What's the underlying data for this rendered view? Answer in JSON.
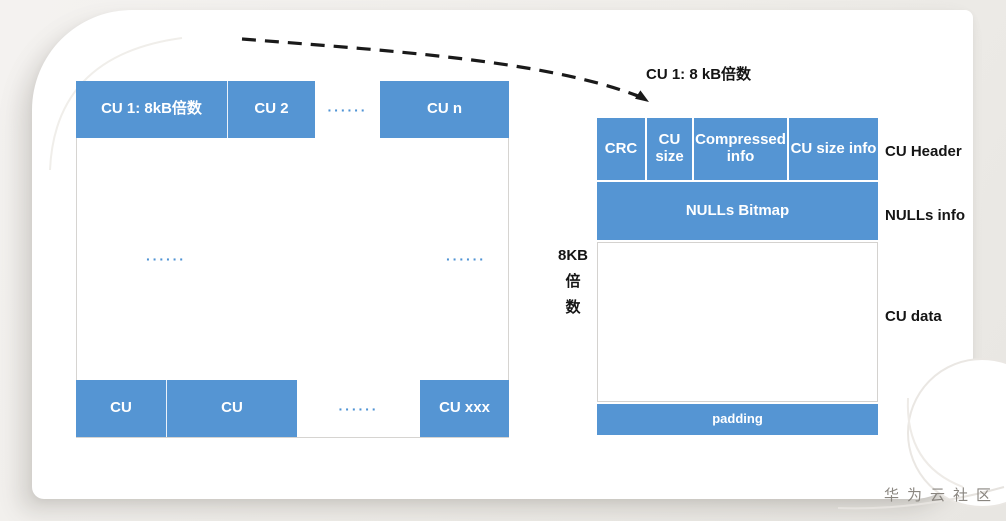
{
  "colors": {
    "accent_blue": "#5595d3",
    "page_bg": "#f1efec",
    "card_bg": "#ffffff",
    "border_gray": "#d6d4d1",
    "label_black": "#151515",
    "watermark_gray": "#8a8680"
  },
  "left_diagram": {
    "top_cells": [
      "CU 1: 8kB倍数",
      "CU 2",
      "CU n"
    ],
    "top_dots": "······",
    "mid_dots_left": "······",
    "mid_dots_right": "······",
    "bottom_cells": [
      "CU",
      "CU",
      "CU xxx"
    ],
    "bottom_dots": "······"
  },
  "callout": {
    "label": "CU 1: 8 kB倍数"
  },
  "right_diagram": {
    "size_label_lines": [
      "8KB",
      "倍",
      "数"
    ],
    "header_cells": [
      "CRC",
      "CU size",
      "Compressed info",
      "CU size info"
    ],
    "nulls_bitmap_label": "NULLs Bitmap",
    "padding_label": "padding",
    "side_labels": [
      "CU Header",
      "NULLs info",
      "CU data"
    ]
  },
  "watermark": "华为云社区"
}
